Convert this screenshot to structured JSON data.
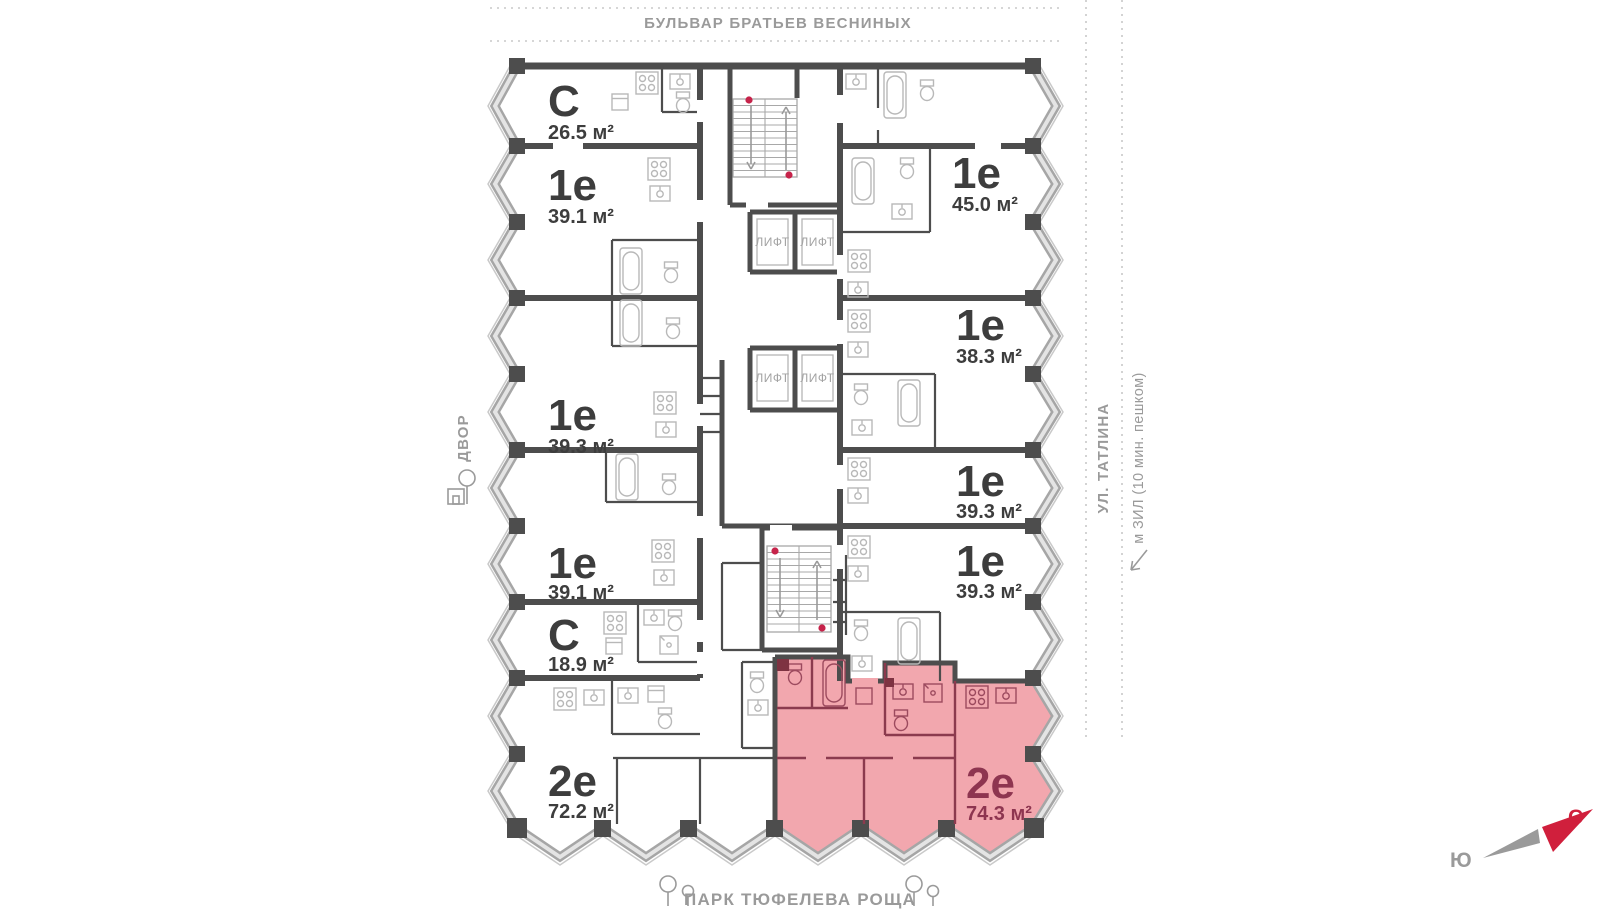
{
  "surroundings": {
    "boulevard": "БУЛЬВАР БРАТЬЕВ ВЕСНИНЫХ",
    "courtyard": "ДВОР",
    "street_right": "УЛ. ТАТЛИНА",
    "metro": "м ЗИЛ (10 мин. пешком)",
    "park": "ПАРК ТЮФЕЛЕВА РОЩА"
  },
  "compass": {
    "north": "С",
    "south": "Ю"
  },
  "core": {
    "elevator_label": "ЛИФТ"
  },
  "apartments": [
    {
      "type": "С",
      "area": "26.5 м²",
      "highlighted": false
    },
    {
      "type": "1е",
      "area": "39.1 м²",
      "highlighted": false
    },
    {
      "type": "1е",
      "area": "39.3 м²",
      "highlighted": false
    },
    {
      "type": "1е",
      "area": "39.1 м²",
      "highlighted": false
    },
    {
      "type": "С",
      "area": "18.9 м²",
      "highlighted": false
    },
    {
      "type": "2е",
      "area": "72.2 м²",
      "highlighted": false
    },
    {
      "type": "1е",
      "area": "45.0 м²",
      "highlighted": false
    },
    {
      "type": "1е",
      "area": "38.3 м²",
      "highlighted": false
    },
    {
      "type": "1е",
      "area": "39.3 м²",
      "highlighted": false
    },
    {
      "type": "1е",
      "area": "39.3 м²",
      "highlighted": false
    },
    {
      "type": "2е",
      "area": "74.3 м²",
      "highlighted": true
    }
  ],
  "colors": {
    "wall": "#4d4d4d",
    "fixtures": "#b8b8b8",
    "glazing": "#a6a6a6",
    "label_text": "#3d3d3d",
    "muted_text": "#9a9a9a",
    "highlight_fill": "#f2a7ae",
    "highlight_wall": "#8c3a4e",
    "highlight_text": "#8e3550",
    "stair_dot": "#c6234a",
    "compass_north": "#d01f3c"
  }
}
